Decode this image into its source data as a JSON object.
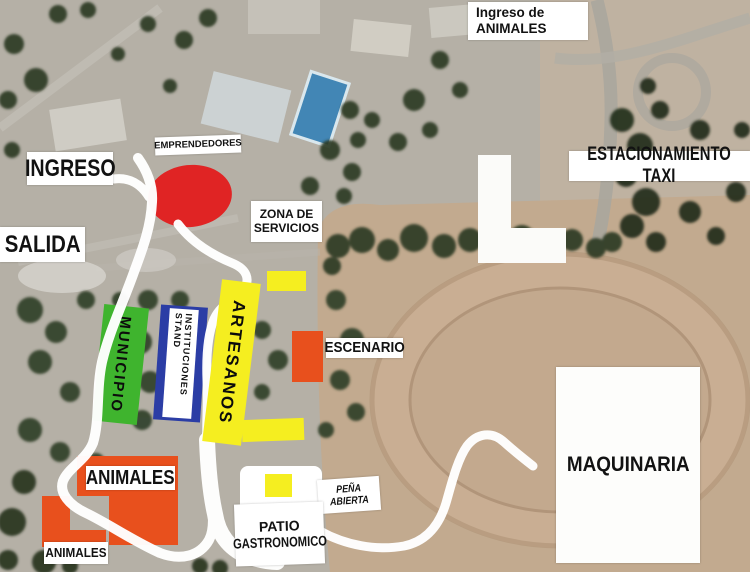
{
  "labels": {
    "ingreso_de_animales": [
      "Ingreso de",
      "ANIMALES"
    ],
    "emprendedores": "EMPRENDEDORES",
    "ingreso": "INGRESO",
    "salida": "SALIDA",
    "estacionamiento_taxi": "ESTACIONAMIENTO TAXI",
    "zona_de_servicios": [
      "ZONA DE",
      "SERVICIOS"
    ],
    "municipio": "MUNICIPIO",
    "stand_instituciones": [
      "STAND",
      "INSTITUCIONES"
    ],
    "artesanos": "ARTESANOS",
    "escenario": "ESCENARIO",
    "animales_grande": "ANIMALES",
    "animales_chico": "ANIMALES",
    "pena_abierta": "PEÑA ABIERTA",
    "patio_gastronomico": [
      "PATIO",
      "GASTRONOMICO"
    ],
    "maquinaria": "MAQUINARIA"
  },
  "colors": {
    "marker_red": "#e02424",
    "marker_green": "#3fb42e",
    "marker_blue": "#2b3da5",
    "marker_yellow": "#f5ee20",
    "marker_orange": "#e8501d",
    "route": "#ffffff",
    "label_background": "#ffffff",
    "label_text": "#121212"
  }
}
